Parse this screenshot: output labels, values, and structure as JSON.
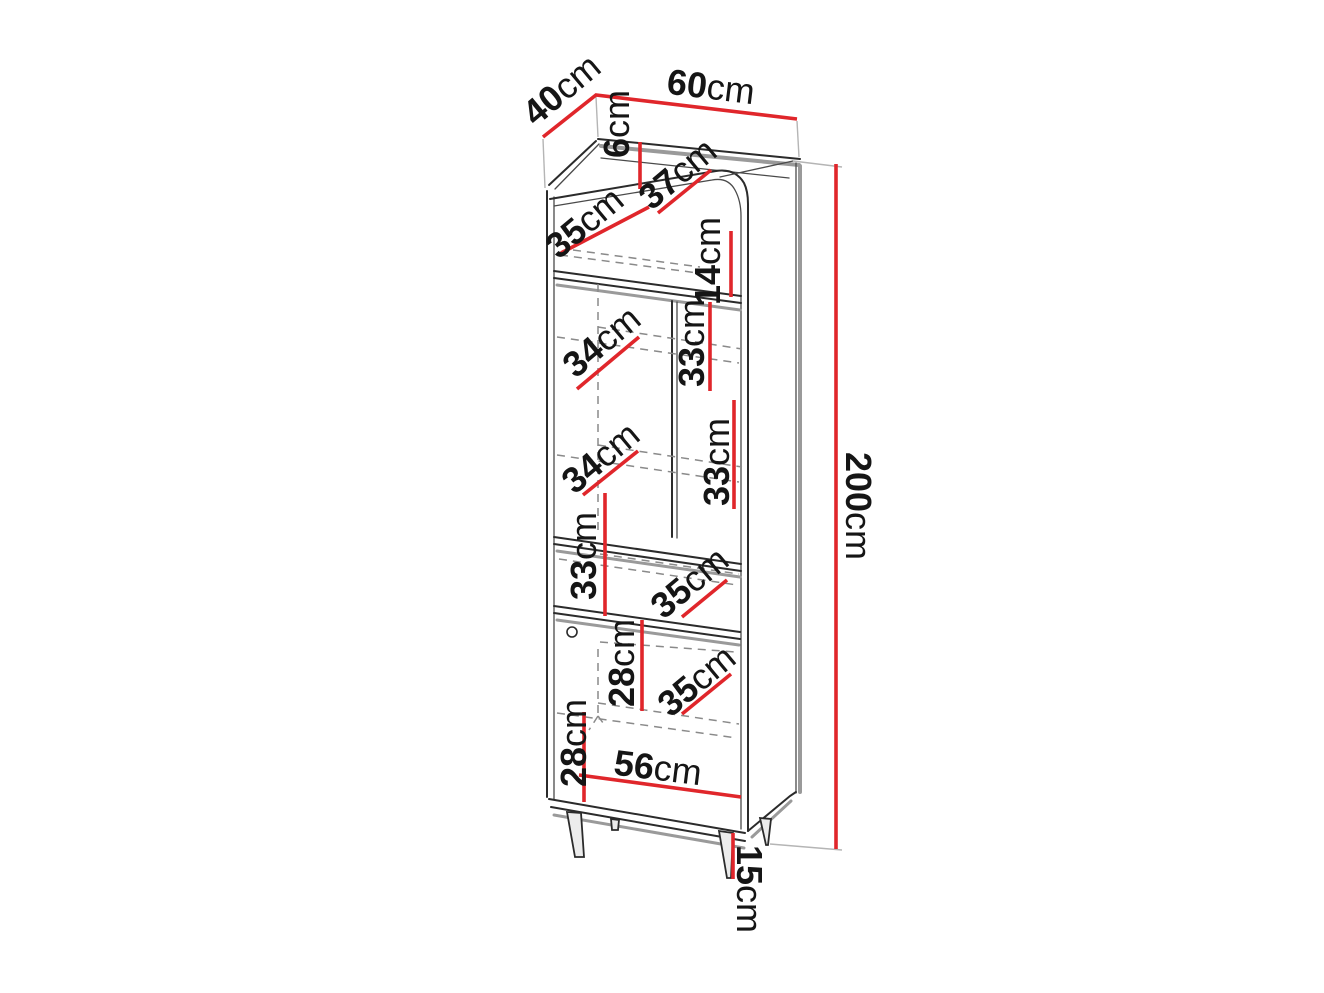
{
  "diagram": {
    "subject": "tall-cabinet-dimension-drawing",
    "unit": "cm",
    "colors": {
      "dimension_line": "#e0262b",
      "outline": "#2b2b2b",
      "shading": "#9a9a9a",
      "hidden_line": "#8a8a8a",
      "background": "#ffffff"
    },
    "overall": {
      "width": "60cm",
      "depth": "40cm",
      "height": "200cm",
      "leg_height": "15cm",
      "interior_width": "56cm"
    },
    "labels": {
      "top_depth": {
        "num": "40",
        "unit": "cm"
      },
      "top_width": {
        "num": "60",
        "unit": "cm"
      },
      "rim_height": {
        "num": "6",
        "unit": "cm"
      },
      "top_surface_depth": {
        "num": "35",
        "unit": "cm"
      },
      "top_board_depth": {
        "num": "37",
        "unit": "cm"
      },
      "niche_height": {
        "num": "14",
        "unit": "cm"
      },
      "upper_shelf_depth_1": {
        "num": "34",
        "unit": "cm"
      },
      "upper_section_h_1": {
        "num": "33",
        "unit": "cm"
      },
      "upper_shelf_depth_2": {
        "num": "34",
        "unit": "cm"
      },
      "upper_section_h_2": {
        "num": "33",
        "unit": "cm"
      },
      "middle_section_h": {
        "num": "33",
        "unit": "cm"
      },
      "middle_shelf_depth": {
        "num": "35",
        "unit": "cm"
      },
      "lower_section_h_1": {
        "num": "28",
        "unit": "cm"
      },
      "lower_shelf_depth": {
        "num": "35",
        "unit": "cm"
      },
      "lower_section_h_2": {
        "num": "28",
        "unit": "cm"
      },
      "interior_width": {
        "num": "56",
        "unit": "cm"
      },
      "total_height": {
        "num": "200",
        "unit": "cm"
      },
      "leg_height": {
        "num": "15",
        "unit": "cm"
      }
    }
  }
}
